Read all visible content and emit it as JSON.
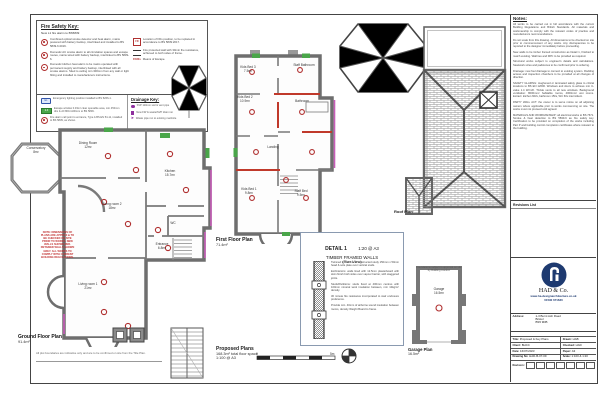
{
  "fire_key": {
    "title": "Fire Safety Key:",
    "subtitle": "New L1 fire alarm to BS5839",
    "left": [
      {
        "t": "Combined optical smoke detector and heat alarm, mains powered with battery backup, interlinked and installed to BS 5839-6:2019."
      },
      {
        "t": "Domestic AC smoke alarm to all circulation spaces and escape routes, mains wired with battery backup, interlinked to BS 5839-6."
      },
      {
        "t": "Domestic kitchen heat alarm to be mains operated with permanent supply and battery backup, interlinked with all smoke alarms. Sited to ceiling min 300mm from any wall or light fitting and installed to manufacturers instructions."
      }
    ],
    "right": [
      {
        "il": "FD",
        "t": "Location of FDs position, to be replaced in accordance to BS 5839:2017."
      },
      {
        "il": "",
        "t": "Fire protected wall with 30min fire resistance, achieved to both sides of frame."
      },
      {
        "il": "FD30s",
        "t": "Means of Escape."
      }
    ]
  },
  "fire_key2": {
    "items": [
      {
        "il": "EL",
        "t": "Emergency lighting position installed to BS 5266-1."
      },
      {
        "il": "2-3",
        "t": "Escape window 0.33m² clear openable area, min 450mm dim & cill 800-1100mm to BS 5839."
      },
      {
        "il": "",
        "t": "Fire alarm call point to entrance, Type A BS EN 54-11, installed to BS 5839, as shown."
      },
      {
        "il": "",
        "t": "Fire alarm light & sounder to BS EN 54-3 & 54-23."
      }
    ]
  },
  "drainage_key": {
    "title": "Drainage Key:",
    "items": [
      {
        "t": "SVP 110mm soil & vent pipe"
      },
      {
        "t": "New FW & waste/SVP drain run"
      },
      {
        "t": "Waste pipe run to existing manhole"
      }
    ]
  },
  "ground_floor": {
    "title": "Ground Floor Plan",
    "area": "91.4m²",
    "rooms": [
      {
        "n": "Conservatory",
        "a": "8m²"
      },
      {
        "n": "Dining Room",
        "a": "12m²"
      },
      {
        "n": "Kitchen",
        "a": "15.7m²"
      },
      {
        "n": "Living room 2",
        "a": "18m²"
      },
      {
        "n": "Entrance",
        "a": "6.8m²"
      },
      {
        "n": "WC",
        "a": ""
      },
      {
        "n": "Living room 1",
        "a": "21m²"
      }
    ],
    "red_note": "NOTE: DIMENSIONS OF PLANS ARE APPROX & TO BE CHECKED ON SITE PRIOR TO WORKS. NEW WALLS SHOWN RED. RETAINED WALLS SHOWN GREY. ALL WORKS TO COMPLY WITH CURRENT BUILDING REGULATIONS."
  },
  "first_floor": {
    "title": "First Floor Plan",
    "area": "71.4m²",
    "rooms": [
      {
        "n": "Kids Bed 3",
        "a": "7.5m²"
      },
      {
        "n": "Staff Bathroom",
        "a": ""
      },
      {
        "n": "Kids Bed 2",
        "a": "10.9m²"
      },
      {
        "n": "Bathroom",
        "a": ""
      },
      {
        "n": "Landing",
        "a": ""
      },
      {
        "n": "Kids Bed 1",
        "a": "9.8m²"
      },
      {
        "n": "Staff Bed",
        "a": "9.5m²"
      }
    ]
  },
  "roof": {
    "label": "Roof Plan"
  },
  "garage": {
    "note": "Foundations subject to approval on site by Building Control.",
    "room": "Garage",
    "room_area": "16.5m²",
    "label": "Garage Plan",
    "label_area": "16.5m²"
  },
  "detail": {
    "heading": "DETAIL 1",
    "scale": "1:20 @ A3",
    "sub1": "TIMBER FRAMED WALLS",
    "sub2": "(Plan View)",
    "paras": [
      "Twinned timber frame constructed study 150mm x 50mm head & sole plate over vertical studs.",
      "Ext/Interiors: walls lined with 12.5mm plasterboard with skim finish both sides over vapour barrier, with staggered joints.",
      "Studs/Partitions: studs fixed at 400mm centres with 100mm mineral wool insulation between, min 10kg/m³ density.",
      "30 minute fire resistance incorporated to stair enclosure preference.",
      "Provide min. 40mm of airborne sound insulation between rooms, density Weight Board to frame."
    ]
  },
  "proposed": {
    "title": "Proposed Plans",
    "line2": "168.3m² total floor space",
    "line3": "1:100 @ A3"
  },
  "boundary_note": "All plot boundaries are indicative only and are to be confirmed on site from the Title Plan.",
  "notes": {
    "title": "Notes:",
    "paras": [
      "All works to be carried out in full accordance with the current Building Regulations and British Standards. All materials and workmanship to comply with the relevant codes of practice and manufacturers recommendations.",
      "Do not scale from this drawing. All dimensions to be checked on site prior to commencement of any works. Any discrepancies to be reported to the designer immediately before proceeding.",
      "New walls to be timber framed construction as Detail 1, finished to match existing. Wall ties and DPC to be provided as required.",
      "Structural works subject to engineer's details and calculations. Steelwork sizes and padstones to be confirmed prior to ordering.",
      "Drainage: new foul drainage to connect to existing system. Rodding access and inspection chambers to be provided at all changes of direction.",
      "SAFETY GLAZING: toughened or laminated safety glass to critical locations to BS EN 12600. Windows and doors to achieve min U-value 1.4 W/m²K. Trickle vents to all new windows. Background ventilation: 8000mm² habitable rooms, 4000mm² wet rooms. Extract: kitchen 60l/s, bathroom 15l/s, WC 6l/s intermittent.",
      "PARTY WALL ACT: the owner is to serve notice on all adjoining owners where applicable prior to works commencing on site. The works must not proceed until agreed.",
      "MATERIALS AND WORKMANSHIP: all electrical works to BS 7671. Smoke & heat detection to BS 5839-6 as fire safety key. Certification to be provided on completion of the works including Part P and building control completion certificates where relevant to the building."
    ]
  },
  "revisions": {
    "title": "Revisions List"
  },
  "title_block": {
    "company": "HAD & Co.",
    "website": "www.ha-designarchitecture.co.uk",
    "phone": "01590 671630",
    "address_label": "Address:",
    "address1": "1-3 Burnt Ash Road",
    "address2": "Bristol",
    "address3": "BS5 9DB",
    "f_title_l": "Title:",
    "f_title_v": "Proposed & Key Plans",
    "f_drawn_l": "Drawn:",
    "f_drawn_v": "HAB",
    "f_client_l": "Client:",
    "f_client_v": "BHCC",
    "f_checked_l": "Checked:",
    "f_checked_v": "HAD",
    "f_date_l": "Date:",
    "f_date_v": "16/07/2023",
    "f_paper_l": "Paper:",
    "f_paper_v": "A3",
    "f_dwg_l": "Drawing No:",
    "f_dwg_v": "HAD-B-07-09",
    "f_scale_l": "Scale:",
    "f_scale_v": "1:100 & 1:20",
    "revision_label": "Revision:"
  },
  "scale_bar": {
    "start": "0",
    "end": "5m"
  }
}
